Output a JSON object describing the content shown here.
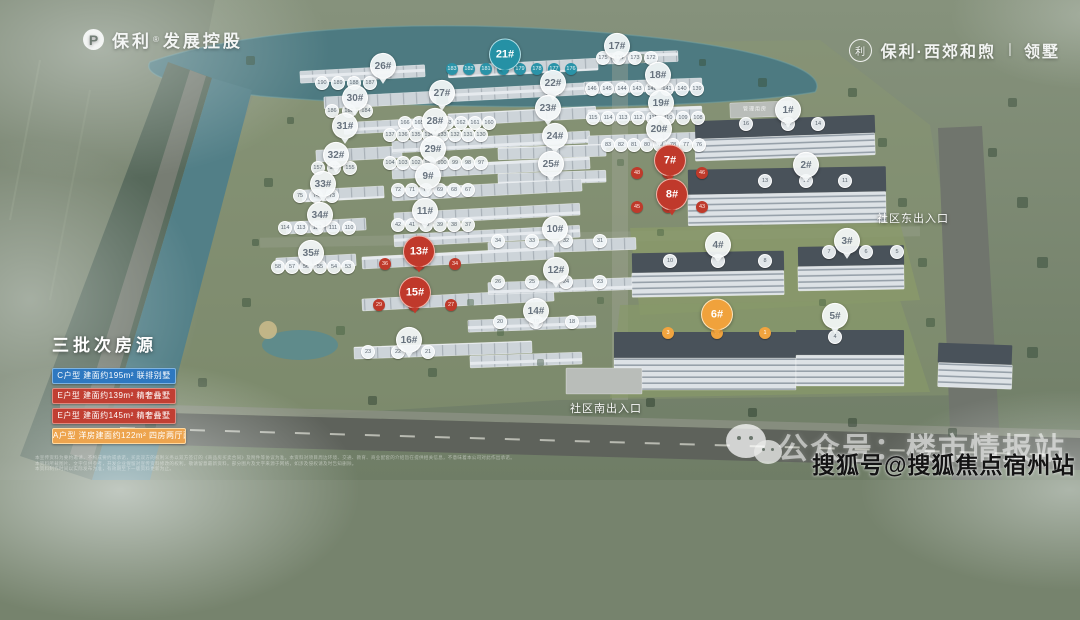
{
  "brand": {
    "left": {
      "icon_letter": "P",
      "name": "保利",
      "reg": "®",
      "suffix": "发展控股"
    },
    "right": {
      "icon_char": "利",
      "title": "保利·西郊和煦",
      "divider": "丨",
      "suffix": "领墅"
    }
  },
  "legend": {
    "title": "三批次房源",
    "rows": [
      {
        "bg": "#2e78c0",
        "border": "#7fb3e0",
        "text": "C户型 建面约195m² 联排别墅"
      },
      {
        "bg": "#c13f33",
        "border": "#e08a7f",
        "text": "E户型 建面约139m² 精奢叠墅"
      },
      {
        "bg": "#c13f33",
        "border": "#e08a7f",
        "text": "E户型 建面约145m² 精奢叠墅"
      },
      {
        "bg": "#eda44e",
        "border": "#ffd9a0",
        "text": "A户型 洋房建面约122m² 四房两厅两卫"
      }
    ]
  },
  "map": {
    "management_label": "管理用房",
    "entrances": [
      {
        "label": "社区东出入口",
        "x": 913,
        "y": 218
      },
      {
        "label": "社区南出入口",
        "x": 606,
        "y": 408
      }
    ],
    "badges": [
      {
        "label": "26#",
        "x": 383,
        "y": 68,
        "color": "white",
        "size": "small"
      },
      {
        "label": "21#",
        "x": 505,
        "y": 57,
        "color": "teal",
        "size": "big"
      },
      {
        "label": "17#",
        "x": 617,
        "y": 48,
        "color": "white",
        "size": "small"
      },
      {
        "label": "30#",
        "x": 355,
        "y": 100,
        "color": "white",
        "size": "small"
      },
      {
        "label": "27#",
        "x": 442,
        "y": 95,
        "color": "white",
        "size": "small"
      },
      {
        "label": "22#",
        "x": 553,
        "y": 85,
        "color": "white",
        "size": "small"
      },
      {
        "label": "18#",
        "x": 658,
        "y": 77,
        "color": "white",
        "size": "small"
      },
      {
        "label": "31#",
        "x": 345,
        "y": 128,
        "color": "white",
        "size": "small"
      },
      {
        "label": "28#",
        "x": 435,
        "y": 123,
        "color": "white",
        "size": "small"
      },
      {
        "label": "23#",
        "x": 548,
        "y": 110,
        "color": "white",
        "size": "small"
      },
      {
        "label": "19#",
        "x": 661,
        "y": 105,
        "color": "white",
        "size": "small"
      },
      {
        "label": "32#",
        "x": 336,
        "y": 157,
        "color": "white",
        "size": "small"
      },
      {
        "label": "29#",
        "x": 433,
        "y": 151,
        "color": "white",
        "size": "small"
      },
      {
        "label": "24#",
        "x": 555,
        "y": 138,
        "color": "white",
        "size": "small"
      },
      {
        "label": "20#",
        "x": 659,
        "y": 131,
        "color": "white",
        "size": "small"
      },
      {
        "label": "33#",
        "x": 323,
        "y": 186,
        "color": "white",
        "size": "small"
      },
      {
        "label": "9#",
        "x": 428,
        "y": 178,
        "color": "white",
        "size": "small"
      },
      {
        "label": "25#",
        "x": 551,
        "y": 166,
        "color": "white",
        "size": "small"
      },
      {
        "label": "34#",
        "x": 320,
        "y": 217,
        "color": "white",
        "size": "small"
      },
      {
        "label": "11#",
        "x": 425,
        "y": 213,
        "color": "white",
        "size": "small"
      },
      {
        "label": "10#",
        "x": 555,
        "y": 231,
        "color": "white",
        "size": "small"
      },
      {
        "label": "35#",
        "x": 311,
        "y": 255,
        "color": "white",
        "size": "small"
      },
      {
        "label": "13#",
        "x": 419,
        "y": 254,
        "color": "red",
        "size": "big"
      },
      {
        "label": "12#",
        "x": 556,
        "y": 272,
        "color": "white",
        "size": "small"
      },
      {
        "label": "15#",
        "x": 415,
        "y": 295,
        "color": "red",
        "size": "big"
      },
      {
        "label": "14#",
        "x": 536,
        "y": 313,
        "color": "white",
        "size": "small"
      },
      {
        "label": "16#",
        "x": 409,
        "y": 342,
        "color": "white",
        "size": "small"
      },
      {
        "label": "7#",
        "x": 670,
        "y": 163,
        "color": "red",
        "size": "big"
      },
      {
        "label": "8#",
        "x": 672,
        "y": 197,
        "color": "red",
        "size": "big"
      },
      {
        "label": "1#",
        "x": 788,
        "y": 112,
        "color": "white",
        "size": "small"
      },
      {
        "label": "2#",
        "x": 806,
        "y": 167,
        "color": "white",
        "size": "small"
      },
      {
        "label": "4#",
        "x": 718,
        "y": 247,
        "color": "white",
        "size": "small"
      },
      {
        "label": "3#",
        "x": 847,
        "y": 243,
        "color": "white",
        "size": "small"
      },
      {
        "label": "6#",
        "x": 717,
        "y": 317,
        "color": "orange",
        "size": "big"
      },
      {
        "label": "5#",
        "x": 835,
        "y": 318,
        "color": "white",
        "size": "small"
      }
    ],
    "unit_rows": [
      {
        "color": "t",
        "y": 69,
        "xs": [
          452,
          469,
          486,
          503,
          520,
          537,
          554,
          571
        ],
        "values": [
          183,
          182,
          181,
          180,
          179,
          178,
          177,
          176
        ]
      },
      {
        "color": "w",
        "y": 58,
        "xs": [
          603,
          619,
          635,
          651
        ],
        "values": [
          175,
          174,
          173,
          172
        ]
      },
      {
        "color": "w",
        "y": 89,
        "xs": [
          592,
          607,
          622,
          637,
          652,
          667,
          682,
          697
        ],
        "values": [
          146,
          145,
          144,
          143,
          142,
          141,
          140,
          139
        ]
      },
      {
        "color": "w",
        "y": 118,
        "xs": [
          593,
          608,
          623,
          638,
          653,
          668,
          683,
          698
        ],
        "values": [
          115,
          114,
          113,
          112,
          111,
          110,
          109,
          108
        ]
      },
      {
        "color": "w",
        "y": 145,
        "xs": [
          608,
          621,
          634,
          647,
          660,
          673,
          686,
          699
        ],
        "values": [
          83,
          82,
          81,
          80,
          79,
          78,
          77,
          76
        ]
      },
      {
        "color": "w",
        "y": 83,
        "xs": [
          322,
          338,
          354,
          370
        ],
        "values": [
          190,
          189,
          188,
          187
        ]
      },
      {
        "color": "w",
        "y": 111,
        "xs": [
          332,
          349,
          366
        ],
        "values": [
          186,
          185,
          184
        ]
      },
      {
        "color": "w",
        "y": 123,
        "xs": [
          405,
          419,
          433,
          447,
          461,
          475,
          489
        ],
        "values": [
          166,
          165,
          164,
          163,
          162,
          161,
          160
        ]
      },
      {
        "color": "w",
        "y": 135,
        "xs": [
          390,
          403,
          416,
          429,
          442,
          455,
          468,
          481
        ],
        "values": [
          137,
          136,
          135,
          134,
          133,
          132,
          131,
          130
        ]
      },
      {
        "color": "w",
        "y": 163,
        "xs": [
          390,
          403,
          416,
          429,
          442,
          455,
          468,
          481
        ],
        "values": [
          104,
          103,
          102,
          101,
          100,
          99,
          98,
          97
        ]
      },
      {
        "color": "w",
        "y": 190,
        "xs": [
          398,
          412,
          426,
          440,
          454,
          468
        ],
        "values": [
          72,
          71,
          70,
          69,
          68,
          67
        ]
      },
      {
        "color": "w",
        "y": 225,
        "xs": [
          398,
          412,
          426,
          440,
          454,
          468
        ],
        "values": [
          42,
          41,
          40,
          39,
          38,
          37
        ]
      },
      {
        "color": "w",
        "y": 168,
        "xs": [
          318,
          334,
          350
        ],
        "values": [
          157,
          156,
          155
        ]
      },
      {
        "color": "w",
        "y": 196,
        "xs": [
          300,
          316,
          332
        ],
        "values": [
          75,
          74,
          73
        ]
      },
      {
        "color": "w",
        "y": 228,
        "xs": [
          285,
          301,
          317,
          333,
          349
        ],
        "values": [
          114,
          113,
          112,
          111,
          110
        ]
      },
      {
        "color": "w",
        "y": 267,
        "xs": [
          278,
          292,
          306,
          320,
          334,
          348
        ],
        "values": [
          58,
          57,
          56,
          55,
          54,
          53
        ]
      },
      {
        "color": "r",
        "y": 264,
        "xs": [
          385,
          419,
          455
        ],
        "values": [
          36,
          35,
          34
        ]
      },
      {
        "color": "r",
        "y": 305,
        "xs": [
          379,
          414,
          451
        ],
        "values": [
          29,
          28,
          27
        ]
      },
      {
        "color": "r",
        "y": 173,
        "xs": [
          637,
          668,
          702
        ],
        "values": [
          48,
          47,
          46
        ]
      },
      {
        "color": "r",
        "y": 207,
        "xs": [
          637,
          668,
          702
        ],
        "values": [
          45,
          44,
          43
        ]
      },
      {
        "color": "o",
        "y": 333,
        "xs": [
          668,
          717,
          765
        ],
        "values": [
          3,
          2,
          1
        ]
      },
      {
        "color": "w",
        "y": 124,
        "xs": [
          746,
          788,
          818
        ],
        "values": [
          16,
          15,
          14
        ]
      },
      {
        "color": "w",
        "y": 181,
        "xs": [
          765,
          806,
          845
        ],
        "values": [
          13,
          12,
          11
        ]
      },
      {
        "color": "w",
        "y": 261,
        "xs": [
          670,
          718,
          765
        ],
        "values": [
          10,
          9,
          8
        ]
      },
      {
        "color": "w",
        "y": 252,
        "xs": [
          829,
          866,
          897
        ],
        "values": [
          7,
          6,
          5
        ]
      },
      {
        "color": "w",
        "y": 337,
        "xs": [
          835
        ],
        "values": [
          4
        ]
      },
      {
        "color": "w",
        "y": 241,
        "xs": [
          498,
          532,
          566,
          600
        ],
        "values": [
          34,
          33,
          32,
          31
        ]
      },
      {
        "color": "w",
        "y": 282,
        "xs": [
          498,
          532,
          566,
          600
        ],
        "values": [
          26,
          25,
          24,
          23
        ]
      },
      {
        "color": "w",
        "y": 322,
        "xs": [
          500,
          536,
          572
        ],
        "values": [
          20,
          19,
          18
        ]
      },
      {
        "color": "w",
        "y": 352,
        "xs": [
          368,
          398,
          428
        ],
        "values": [
          23,
          22,
          21
        ]
      }
    ]
  },
  "watermark": {
    "wechat_text": "公众号：楼市情报站",
    "sohu_text": "搜狐号@搜狐焦点宿州站"
  },
  "disclaimer": {
    "lines": [
      "本宣传资料为要约邀请，不构成要约或承诺，买卖双方的权利义务以双方签订的《商品房买卖合同》及附件等协议为准。本资料对项目周边环境、交通、教育、商业配套的介绍旨在提供相关信息，不意味着本公司对此作出承诺。",
      "本资料所载图片、文字仅供参考，开发企业保留对宣传资料修改的权利，敬请留意最新资料。部分图片及文字来源于网络，如涉及侵权请及时告知删除。",
      "本资料制作时间以实际发布为准，有效期至下一版资料更新为止。"
    ]
  },
  "colors": {
    "red": "#c0392b",
    "teal": "#2591a5",
    "orange": "#f0a23c",
    "blue": "#2e78c0"
  }
}
